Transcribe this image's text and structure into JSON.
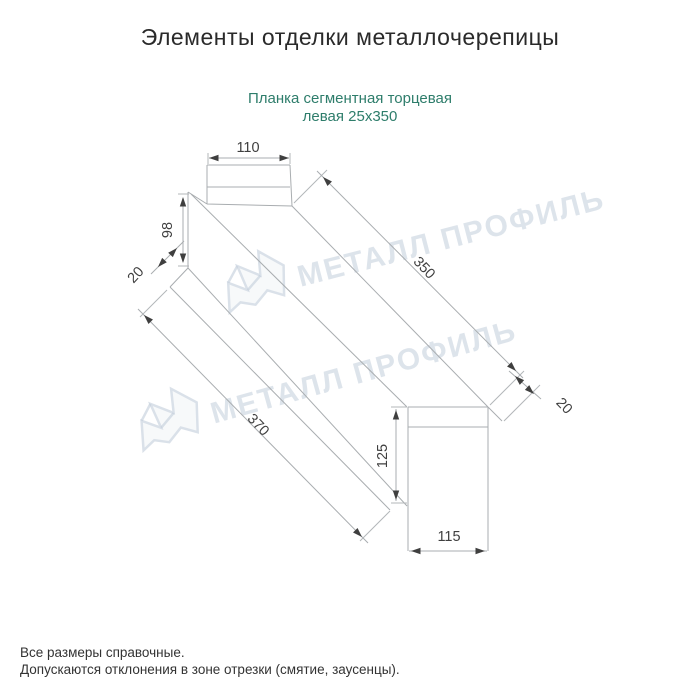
{
  "page": {
    "title": "Элементы отделки металлочерепицы",
    "subtitle_line1": "Планка сегментная торцевая",
    "subtitle_line2": "левая 25x350"
  },
  "diagram": {
    "dims": {
      "top_width": "110",
      "left_height": "98",
      "left_flange": "20",
      "length_top": "350",
      "length_bottom": "370",
      "right_flange": "20",
      "end_height": "125",
      "end_width": "115"
    }
  },
  "watermark": {
    "text": "МЕТАЛЛ ПРОФИЛЬ"
  },
  "footer": {
    "line1": "Все размеры справочные.",
    "line2": "Допускаются отклонения в зоне отрезки (смятие, заусенцы)."
  },
  "colors": {
    "subtitle_accent": "#2e7d6b",
    "watermark": "#c3cedb",
    "drawing_line": "#a9adb0",
    "dimension_text": "#3f3f3f"
  }
}
